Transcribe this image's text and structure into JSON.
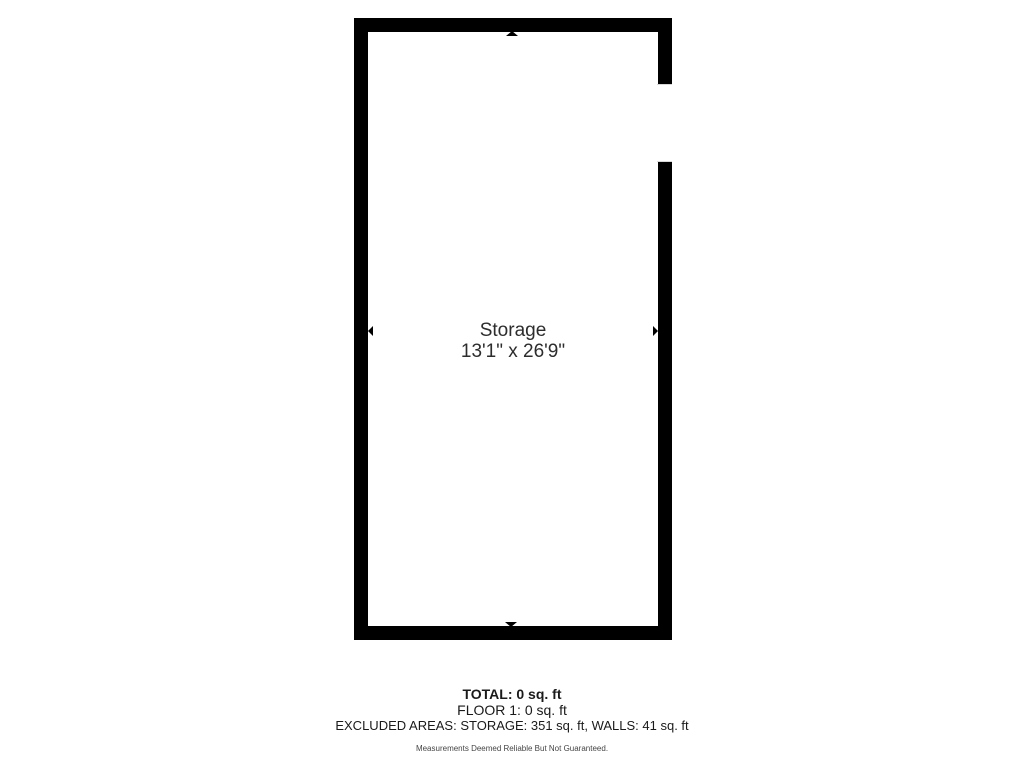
{
  "floorplan": {
    "room": {
      "name": "Storage",
      "dimensions": "13'1\" x 26'9\""
    },
    "icons": [
      "dimension-arrow-up-icon",
      "dimension-arrow-down-icon",
      "dimension-arrow-left-icon",
      "dimension-arrow-right-icon"
    ],
    "features": [
      "window-opening-right-wall"
    ],
    "colors": {
      "wall": "#000000",
      "interior": "#ffffff",
      "label_text": "#2d2d2d"
    }
  },
  "summary": {
    "total": "TOTAL: 0 sq. ft",
    "floor1": "FLOOR 1: 0 sq. ft",
    "excluded": "EXCLUDED AREAS: STORAGE: 351 sq. ft, WALLS: 41 sq. ft",
    "disclaimer": "Measurements Deemed Reliable But Not Guaranteed."
  }
}
